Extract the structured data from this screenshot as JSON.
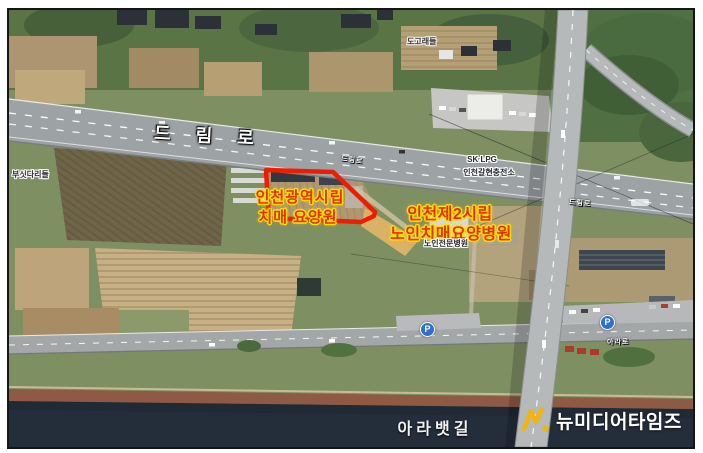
{
  "figure": {
    "type": "annotated-satellite-map"
  },
  "roads": {
    "dream_ro_main_label": "드 림 로",
    "dream_ro_small_label": "드림로",
    "dream_ro_far_label": "드림로",
    "canal_road_label": "아라로"
  },
  "annotations": {
    "facility1_line1": "인천광역시립",
    "facility1_line2": "치매 요양원",
    "facility2_line1": "인천제2시립",
    "facility2_line2": "노인치매요양병원",
    "highlight_color": "#ee1c00",
    "label_color": "#e43000",
    "label_outline_color": "#ffdf00"
  },
  "poi": {
    "gas_station_brand": "SK LPG",
    "gas_station_name": "인천갈현충전소",
    "hospital_name": "노인전문병원",
    "field_name_left": "부싯다리들",
    "field_name_top": "도고래들",
    "parking_icon": "P"
  },
  "waterway": {
    "label": "아라뱃길"
  },
  "watermark": {
    "brand": "뉴미디어타임즈",
    "accent_color": "#f2b50d"
  }
}
